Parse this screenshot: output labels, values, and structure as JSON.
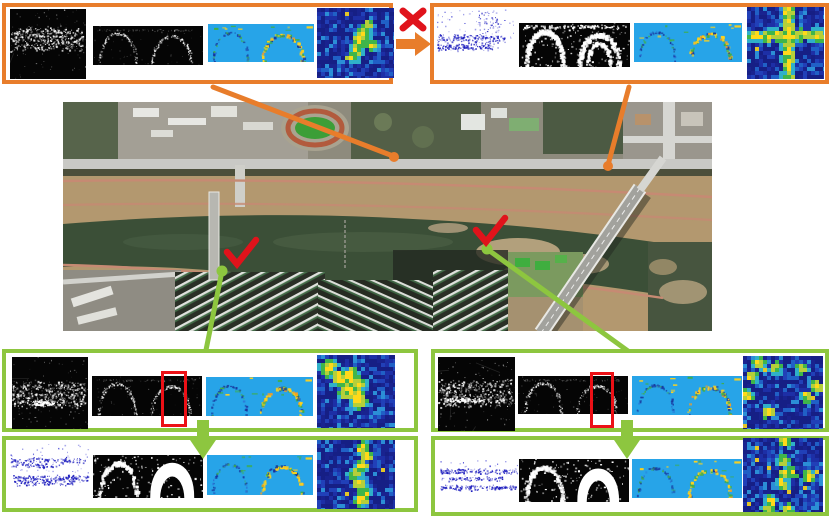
{
  "colors": {
    "accent_orange": "#E87D2B",
    "accent_green": "#8DC63F",
    "mark_red": "#E0131B",
    "highlight_red": "#EC1016",
    "feature_map_blue": "#27A4E8",
    "pointcloud_blue": "#1d1dbe",
    "heatmap_base_blue": "#1d2fa6",
    "heatmap_hot_yellow": "#ffd91a"
  },
  "icons": {
    "cross_icon": {
      "name": "cross-icon",
      "glyph": "✖",
      "color": "#E0131B"
    },
    "check_icon": {
      "name": "check-icon",
      "glyph": "✔",
      "color": "#E0131B"
    },
    "arrow_right_icon": {
      "name": "arrow-right-icon",
      "glyph": "➜",
      "color": "#E87D2B"
    },
    "arrow_down_icon": {
      "name": "arrow-down-icon",
      "glyph": "⬇",
      "color": "#8DC63F"
    }
  },
  "map": {
    "name": "aerial-satellite-map",
    "features": [
      "river",
      "riverside roads",
      "stadium running track",
      "campus buildings",
      "apartment blocks",
      "left bridge",
      "right diagonal bridge",
      "sandbars"
    ]
  },
  "panels": {
    "top_left": {
      "border_color": "#E87D2B",
      "images": [
        {
          "name": "radar-intensity-image",
          "type": "radarDark",
          "seed": 101,
          "variant": "tl"
        },
        {
          "name": "radar-cartesian-image",
          "type": "cartArcs",
          "seed": 102,
          "variant": "faint"
        },
        {
          "name": "feature-map-image",
          "type": "featureMap",
          "seed": 103
        },
        {
          "name": "correlation-heatmap",
          "type": "heatmap",
          "seed": 104,
          "variant": "diag"
        }
      ]
    },
    "top_right": {
      "border_color": "#E87D2B",
      "images": [
        {
          "name": "lidar-pointcloud-image",
          "type": "pointCloud",
          "seed": 111,
          "variant": "tr"
        },
        {
          "name": "binary-radar-image",
          "type": "cartArcs",
          "seed": 112,
          "variant": "binary"
        },
        {
          "name": "feature-map-image",
          "type": "featureMap",
          "seed": 113
        },
        {
          "name": "correlation-heatmap",
          "type": "heatmap",
          "seed": 114,
          "variant": "cross"
        }
      ]
    },
    "bottom_left_top": {
      "border_color": "#8DC63F",
      "has_red_box": true,
      "images": [
        {
          "name": "radar-intensity-image",
          "type": "radarDark",
          "seed": 121,
          "variant": "bl"
        },
        {
          "name": "radar-cartesian-image",
          "type": "cartArcs",
          "seed": 122,
          "variant": "faint"
        },
        {
          "name": "feature-map-image",
          "type": "featureMap",
          "seed": 123
        },
        {
          "name": "correlation-heatmap",
          "type": "heatmap",
          "seed": 124,
          "variant": "blob"
        }
      ]
    },
    "bottom_left_bottom": {
      "border_color": "#8DC63F",
      "images": [
        {
          "name": "lidar-pointcloud-image",
          "type": "pointCloud",
          "seed": 131,
          "variant": "bl2"
        },
        {
          "name": "binary-radar-image",
          "type": "cartArcs",
          "seed": 132,
          "variant": "dome"
        },
        {
          "name": "feature-map-image",
          "type": "featureMap",
          "seed": 133
        },
        {
          "name": "correlation-heatmap",
          "type": "heatmap",
          "seed": 134,
          "variant": "vert"
        }
      ]
    },
    "bottom_right_top": {
      "border_color": "#8DC63F",
      "has_red_box": true,
      "images": [
        {
          "name": "radar-intensity-image",
          "type": "radarDark",
          "seed": 141,
          "variant": "br"
        },
        {
          "name": "radar-cartesian-image",
          "type": "cartArcs",
          "seed": 142,
          "variant": "faint"
        },
        {
          "name": "feature-map-image",
          "type": "featureMap",
          "seed": 143
        },
        {
          "name": "correlation-heatmap",
          "type": "heatmap",
          "seed": 144,
          "variant": "speck"
        }
      ]
    },
    "bottom_right_bottom": {
      "border_color": "#8DC63F",
      "images": [
        {
          "name": "lidar-pointcloud-image",
          "type": "pointCloud",
          "seed": 151,
          "variant": "br2"
        },
        {
          "name": "binary-radar-image",
          "type": "cartArcs",
          "seed": 152,
          "variant": "dome2"
        },
        {
          "name": "feature-map-image",
          "type": "featureMap",
          "seed": 153
        },
        {
          "name": "correlation-heatmap",
          "type": "heatmap",
          "seed": 154,
          "variant": "speck2"
        }
      ]
    }
  }
}
